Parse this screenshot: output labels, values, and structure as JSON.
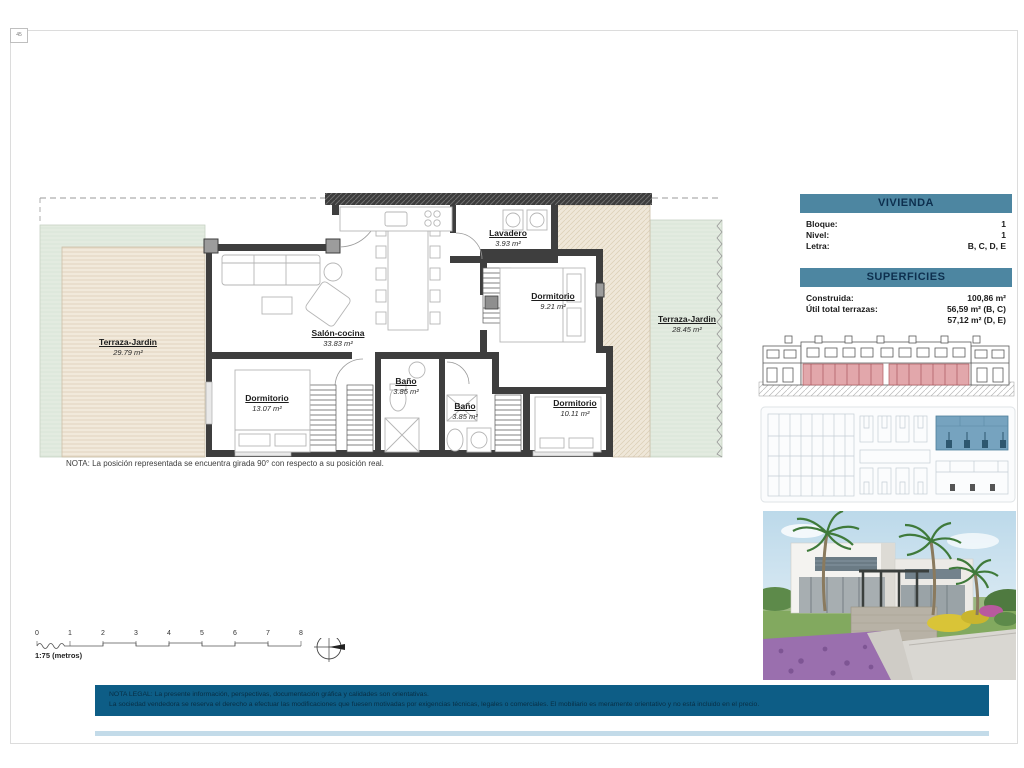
{
  "page": {
    "corner_mark": "45"
  },
  "plan": {
    "rooms": [
      {
        "name": "Terraza-Jardin",
        "area": "29.79 m²"
      },
      {
        "name": "Salón-cocina",
        "area": "33.83 m²"
      },
      {
        "name": "Lavadero",
        "area": "3.93 m²"
      },
      {
        "name": "Dormitorio",
        "area": "9.21 m²"
      },
      {
        "name": "Dormitorio",
        "area": "13.07 m²"
      },
      {
        "name": "Baño",
        "area": "3.85 m²"
      },
      {
        "name": "Baño",
        "area": "3.85 m²"
      },
      {
        "name": "Dormitorio",
        "area": "10.11 m²"
      },
      {
        "name": "Terraza-Jardin",
        "area": "28.45 m²"
      }
    ],
    "note": "NOTA: La posición representada se encuentra girada 90° con respecto a su posición real."
  },
  "scale_bar": {
    "ticks": [
      "0",
      "1",
      "2",
      "3",
      "4",
      "5",
      "6",
      "7",
      "8"
    ],
    "label": "1:75 (metros)"
  },
  "vivienda": {
    "title": "VIVIENDA",
    "rows": [
      {
        "label": "Bloque:",
        "value": "1"
      },
      {
        "label": "Nivel:",
        "value": "1"
      },
      {
        "label": "Letra:",
        "value": "B, C, D, E"
      }
    ]
  },
  "superficies": {
    "title": "SUPERFICIES",
    "rows": [
      {
        "label": "Construida:",
        "value": "100,86 m²"
      },
      {
        "label": "Útil total terrazas:",
        "value": "56,59 m² (B, C)"
      },
      {
        "label": "",
        "value": "57,12 m² (D, E)"
      }
    ]
  },
  "legal": {
    "line1": "NOTA LEGAL: La presente información, perspectivas, documentación gráfica y calidades son orientativas.",
    "line2": "La sociedad vendedora se reserva el derecho a efectuar las modificaciones que fuesen motivadas por exigencias técnicas, legales o comerciales. El mobiliario es meramente orientativo y no está incluido en el precio."
  },
  "colors": {
    "header_bar": "#4d86a1",
    "legal_bar": "#0d5d86",
    "terrace_beige": "#f1e9db",
    "garden_green": "#e3ebe0",
    "wall_dark": "#3e3e3e",
    "site_highlight": "#76a3bf",
    "elevation_highlight": "#e2a7ab"
  }
}
